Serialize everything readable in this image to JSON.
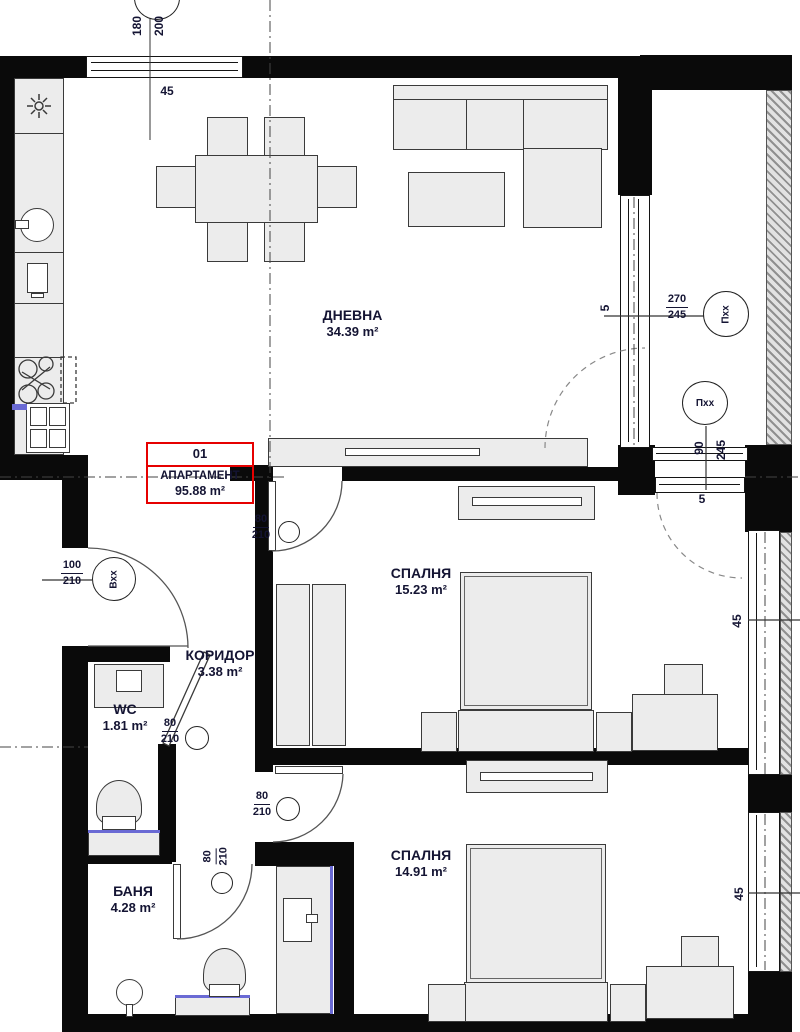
{
  "colors": {
    "wall": "#0a0a0a",
    "accent_red": "#e60000",
    "text": "#141433",
    "fixture_blue": "#6a6ad4"
  },
  "apartment_box": {
    "number": "01",
    "name": "АПАРТАМЕНТ",
    "area": "95.88 m²"
  },
  "rooms": {
    "living": {
      "name": "ДНЕВНА",
      "area": "34.39 m²"
    },
    "bedroom1": {
      "name": "СПАЛНЯ",
      "area": "15.23 m²"
    },
    "bedroom2": {
      "name": "СПАЛНЯ",
      "area": "14.91 m²"
    },
    "corridor": {
      "name": "КОРИДОР",
      "area": "3.38 m²"
    },
    "wc": {
      "name": "WC",
      "area": "1.81 m²"
    },
    "bath": {
      "name": "БАНЯ",
      "area": "4.28 m²"
    }
  },
  "openings": {
    "window_top": {
      "width": "180",
      "height": "200",
      "offset": "45"
    },
    "window_terrace": {
      "width": "270",
      "height": "245",
      "tag": "Пxx",
      "offset": "5"
    },
    "door_terrace": {
      "width": "90",
      "height": "245",
      "tag": "Пxx",
      "offset": "5"
    },
    "door_entrance": {
      "width": "100",
      "height": "210",
      "tag": "Вxx"
    },
    "door_bedroom1": {
      "width": "80",
      "height": "210"
    },
    "door_wc": {
      "width": "80",
      "height": "210"
    },
    "door_bedroom2": {
      "width": "80",
      "height": "210"
    },
    "door_bath": {
      "width": "80",
      "height": "210"
    },
    "wall_tick_bedroom1": "45",
    "wall_tick_bedroom2": "45"
  }
}
